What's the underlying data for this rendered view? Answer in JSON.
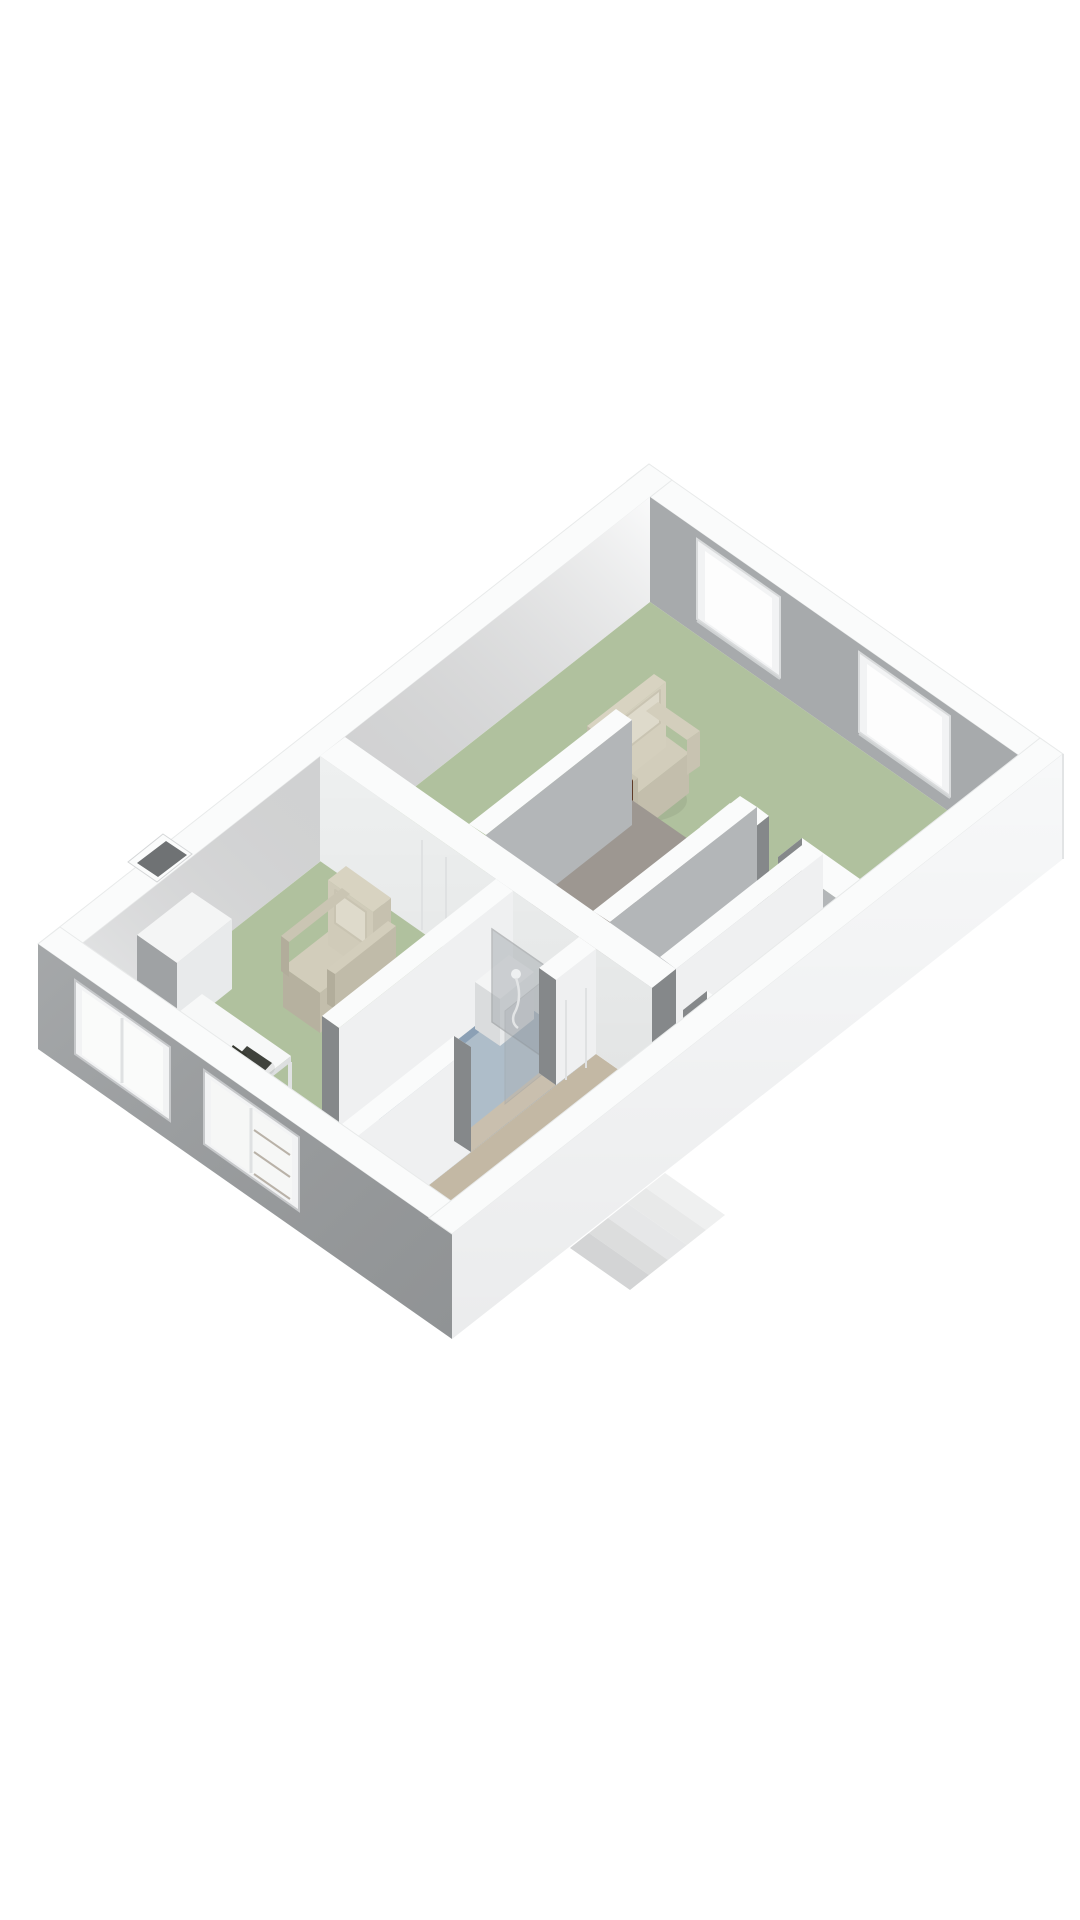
{
  "scene": {
    "kind": "isometric-3d-floorplan-render",
    "background": "#ffffff",
    "floor_level": "single storey cutaway viewed from above"
  },
  "palette": {
    "bg": "#ffffff",
    "wall_top": "#fafbfb",
    "wall_gray_interior": "#a7aaac",
    "wall_gray_side": "#b3b6b8",
    "wall_white_face": "#f3f4f5",
    "ext_sw_wall": "#9b9ea0",
    "ext_se_wall": "#f7f8f9",
    "floor_green": "#b0c19e",
    "floor_blue": "#8ba0b5",
    "shower_tray": "#aebdc9",
    "floor_beige": "#c3b8a4",
    "floor_closet": "#a6a9aa",
    "threshold_tan": "#c9bfae",
    "mattress_gray": "#9d9791",
    "headboard_brown": "#6e4630",
    "armchair_cream": "#d2cdbb",
    "armchair_pillow": "#dedacb",
    "desk_white": "#f7f8f8",
    "chair_dark": "#3f423c",
    "glass_gray": "#aab0b4",
    "window_glazing": "#fdfdfd",
    "window_frame": "#f2f3f4",
    "jamb_dark": "#85888a",
    "flue_dark": "#6f7274",
    "stair_light": "#e6e7e8"
  },
  "rooms": [
    {
      "id": "bedroom-right",
      "floor": "green"
    },
    {
      "id": "living-left",
      "floor": "green"
    },
    {
      "id": "bathroom",
      "floor": "blue"
    },
    {
      "id": "hallway",
      "floor": "beige"
    },
    {
      "id": "closet-a",
      "floor": "gray"
    },
    {
      "id": "closet-b",
      "floor": "gray"
    }
  ],
  "furniture": [
    {
      "id": "armchair-right",
      "room": "bedroom-right"
    },
    {
      "id": "armchair-left",
      "room": "living-left"
    },
    {
      "id": "bed",
      "room": "bedroom-right"
    },
    {
      "id": "nightstand",
      "room": "bedroom-right"
    },
    {
      "id": "radiator-ledge",
      "room": "bedroom-right"
    },
    {
      "id": "desk",
      "room": "living-left"
    },
    {
      "id": "desk-chair",
      "room": "living-left"
    },
    {
      "id": "chimney-column",
      "room": "living-left"
    },
    {
      "id": "shower",
      "room": "bathroom"
    },
    {
      "id": "washbasin",
      "room": "bathroom"
    },
    {
      "id": "bath-cabinet",
      "room": "bathroom"
    },
    {
      "id": "entry-step",
      "room": "hallway"
    },
    {
      "id": "exterior-stairs",
      "room": "outside"
    }
  ],
  "windows": {
    "northeast_wall": 2,
    "southwest_wall": 2
  }
}
